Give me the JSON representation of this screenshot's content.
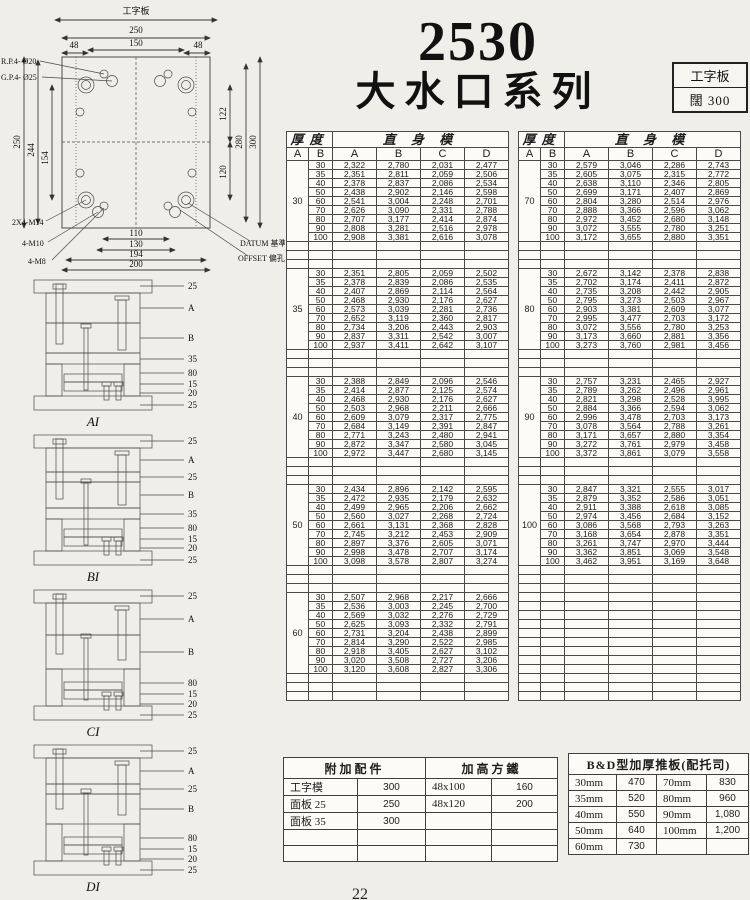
{
  "page": {
    "title_number": "2530",
    "title_series": "大水口系列",
    "page_number": "22"
  },
  "spec_box": {
    "line1": "工字板",
    "line2": "闊 300"
  },
  "drawing": {
    "title": "工字板",
    "dim_250_h": "250",
    "dim_150": "150",
    "dim_48_l": "48",
    "dim_48_r": "48",
    "dim_250_v": "250",
    "dim_244": "244",
    "dim_154": "154",
    "dim_122": "122",
    "dim_120": "120",
    "dim_280": "280",
    "dim_300": "300",
    "dim_110": "110",
    "dim_130": "130",
    "dim_194": "194",
    "dim_200": "200",
    "callout_rp": "R.P.4- Ø20",
    "callout_gp": "G.P.4- Ø25",
    "callout_m14": "2X4-M14",
    "callout_m10": "4-M10",
    "callout_m8": "4-M8",
    "callout_datum": "DATUM 基準",
    "callout_offset": "OFFSET 偏孔"
  },
  "diagrams": [
    {
      "label": "AI",
      "callouts": [
        "25",
        "A",
        "B",
        "35",
        "80",
        "15",
        "20",
        "25"
      ]
    },
    {
      "label": "BI",
      "callouts": [
        "25",
        "A",
        "25",
        "B",
        "35",
        "80",
        "15",
        "20",
        "25"
      ]
    },
    {
      "label": "CI",
      "callouts": [
        "25",
        "A",
        "B",
        "80",
        "15",
        "20",
        "25"
      ]
    },
    {
      "label": "DI",
      "callouts": [
        "25",
        "A",
        "25",
        "B",
        "80",
        "15",
        "20",
        "25"
      ]
    }
  ],
  "table_header": {
    "thickness": "厚度",
    "group": "直 身 模",
    "a": "A",
    "b": "B",
    "ca": "A",
    "cb": "B",
    "cc": "C",
    "cd": "D"
  },
  "left_table": {
    "blocks": [
      {
        "a": "30",
        "rows": [
          [
            "30",
            "2,322",
            "2,780",
            "2,031",
            "2,477"
          ],
          [
            "35",
            "2,351",
            "2,811",
            "2,059",
            "2,506"
          ],
          [
            "40",
            "2,378",
            "2,837",
            "2,086",
            "2,534"
          ],
          [
            "50",
            "2,438",
            "2,902",
            "2,146",
            "2,598"
          ],
          [
            "60",
            "2,541",
            "3,004",
            "2,248",
            "2,701"
          ],
          [
            "70",
            "2,626",
            "3,090",
            "2,331",
            "2,788"
          ],
          [
            "80",
            "2,707",
            "3,177",
            "2,414",
            "2,874"
          ],
          [
            "90",
            "2,808",
            "3,281",
            "2,516",
            "2,978"
          ],
          [
            "100",
            "2,908",
            "3,381",
            "2,616",
            "3,078"
          ]
        ]
      },
      {
        "a": "35",
        "rows": [
          [
            "30",
            "2,351",
            "2,805",
            "2,059",
            "2,502"
          ],
          [
            "35",
            "2,378",
            "2,839",
            "2,086",
            "2,535"
          ],
          [
            "40",
            "2,407",
            "2,869",
            "2,114",
            "2,564"
          ],
          [
            "50",
            "2,468",
            "2,930",
            "2,176",
            "2,627"
          ],
          [
            "60",
            "2,573",
            "3,039",
            "2,281",
            "2,736"
          ],
          [
            "70",
            "2,652",
            "3,119",
            "2,360",
            "2,817"
          ],
          [
            "80",
            "2,734",
            "3,206",
            "2,443",
            "2,903"
          ],
          [
            "90",
            "2,837",
            "3,311",
            "2,542",
            "3,007"
          ],
          [
            "100",
            "2,937",
            "3,411",
            "2,642",
            "3,107"
          ]
        ]
      },
      {
        "a": "40",
        "rows": [
          [
            "30",
            "2,388",
            "2,849",
            "2,096",
            "2,546"
          ],
          [
            "35",
            "2,414",
            "2,877",
            "2,125",
            "2,574"
          ],
          [
            "40",
            "2,468",
            "2,930",
            "2,176",
            "2,627"
          ],
          [
            "50",
            "2,503",
            "2,968",
            "2,211",
            "2,666"
          ],
          [
            "60",
            "2,609",
            "3,079",
            "2,317",
            "2,775"
          ],
          [
            "70",
            "2,684",
            "3,149",
            "2,391",
            "2,847"
          ],
          [
            "80",
            "2,771",
            "3,243",
            "2,480",
            "2,941"
          ],
          [
            "90",
            "2,872",
            "3,347",
            "2,580",
            "3,045"
          ],
          [
            "100",
            "2,972",
            "3,447",
            "2,680",
            "3,145"
          ]
        ]
      },
      {
        "a": "50",
        "rows": [
          [
            "30",
            "2,434",
            "2,896",
            "2,142",
            "2,595"
          ],
          [
            "35",
            "2,472",
            "2,935",
            "2,179",
            "2,632"
          ],
          [
            "40",
            "2,499",
            "2,965",
            "2,206",
            "2,662"
          ],
          [
            "50",
            "2,560",
            "3,027",
            "2,268",
            "2,724"
          ],
          [
            "60",
            "2,661",
            "3,131",
            "2,368",
            "2,828"
          ],
          [
            "70",
            "2,745",
            "3,212",
            "2,453",
            "2,909"
          ],
          [
            "80",
            "2,897",
            "3,376",
            "2,605",
            "3,071"
          ],
          [
            "90",
            "2,998",
            "3,478",
            "2,707",
            "3,174"
          ],
          [
            "100",
            "3,098",
            "3,578",
            "2,807",
            "3,274"
          ]
        ]
      },
      {
        "a": "60",
        "rows": [
          [
            "30",
            "2,507",
            "2,968",
            "2,217",
            "2,666"
          ],
          [
            "35",
            "2,536",
            "3,003",
            "2,245",
            "2,700"
          ],
          [
            "40",
            "2,569",
            "3,032",
            "2,276",
            "2,729"
          ],
          [
            "50",
            "2,625",
            "3,093",
            "2,332",
            "2,791"
          ],
          [
            "60",
            "2,731",
            "3,204",
            "2,438",
            "2,899"
          ],
          [
            "70",
            "2,814",
            "3,290",
            "2,522",
            "2,985"
          ],
          [
            "80",
            "2,918",
            "3,405",
            "2,627",
            "3,102"
          ],
          [
            "90",
            "3,020",
            "3,508",
            "2,727",
            "3,206"
          ],
          [
            "100",
            "3,120",
            "3,608",
            "2,827",
            "3,306"
          ]
        ]
      }
    ]
  },
  "right_table": {
    "blocks": [
      {
        "a": "70",
        "rows": [
          [
            "30",
            "2,579",
            "3,046",
            "2,286",
            "2,743"
          ],
          [
            "35",
            "2,605",
            "3,075",
            "2,315",
            "2,772"
          ],
          [
            "40",
            "2,638",
            "3,110",
            "2,346",
            "2,805"
          ],
          [
            "50",
            "2,699",
            "3,171",
            "2,407",
            "2,869"
          ],
          [
            "60",
            "2,804",
            "3,280",
            "2,514",
            "2,976"
          ],
          [
            "70",
            "2,888",
            "3,366",
            "2,596",
            "3,062"
          ],
          [
            "80",
            "2,972",
            "3,452",
            "2,680",
            "3,148"
          ],
          [
            "90",
            "3,072",
            "3,555",
            "2,780",
            "3,251"
          ],
          [
            "100",
            "3,172",
            "3,655",
            "2,880",
            "3,351"
          ]
        ]
      },
      {
        "a": "80",
        "rows": [
          [
            "30",
            "2,672",
            "3,142",
            "2,378",
            "2,838"
          ],
          [
            "35",
            "2,702",
            "3,174",
            "2,411",
            "2,872"
          ],
          [
            "40",
            "2,735",
            "3,208",
            "2,442",
            "2,905"
          ],
          [
            "50",
            "2,795",
            "3,273",
            "2,503",
            "2,967"
          ],
          [
            "60",
            "2,903",
            "3,381",
            "2,609",
            "3,077"
          ],
          [
            "70",
            "2,995",
            "3,477",
            "2,703",
            "3,172"
          ],
          [
            "80",
            "3,072",
            "3,556",
            "2,780",
            "3,253"
          ],
          [
            "90",
            "3,173",
            "3,660",
            "2,881",
            "3,356"
          ],
          [
            "100",
            "3,273",
            "3,760",
            "2,981",
            "3,456"
          ]
        ]
      },
      {
        "a": "90",
        "rows": [
          [
            "30",
            "2,757",
            "3,231",
            "2,465",
            "2,927"
          ],
          [
            "35",
            "2,789",
            "3,262",
            "2,496",
            "2,961"
          ],
          [
            "40",
            "2,821",
            "3,298",
            "2,528",
            "3,995"
          ],
          [
            "50",
            "2,884",
            "3,366",
            "2,594",
            "3,062"
          ],
          [
            "60",
            "2,996",
            "3,478",
            "2,703",
            "3,173"
          ],
          [
            "70",
            "3,078",
            "3,564",
            "2,788",
            "3,261"
          ],
          [
            "80",
            "3,171",
            "3,657",
            "2,880",
            "3,354"
          ],
          [
            "90",
            "3,272",
            "3,761",
            "2,979",
            "3,458"
          ],
          [
            "100",
            "3,372",
            "3,861",
            "3,079",
            "3,558"
          ]
        ]
      },
      {
        "a": "100",
        "rows": [
          [
            "30",
            "2,847",
            "3,321",
            "2,555",
            "3,017"
          ],
          [
            "35",
            "2,879",
            "3,352",
            "2,586",
            "3,051"
          ],
          [
            "40",
            "2,911",
            "3,388",
            "2,618",
            "3,085"
          ],
          [
            "50",
            "2,974",
            "3,456",
            "2,684",
            "3,152"
          ],
          [
            "60",
            "3,086",
            "3,568",
            "2,793",
            "3,263"
          ],
          [
            "70",
            "3,168",
            "3,654",
            "2,878",
            "3,351"
          ],
          [
            "80",
            "3,261",
            "3,747",
            "2,970",
            "3,444"
          ],
          [
            "90",
            "3,362",
            "3,851",
            "3,069",
            "3,548"
          ],
          [
            "100",
            "3,462",
            "3,951",
            "3,169",
            "3,648"
          ]
        ]
      }
    ]
  },
  "accessories_table": {
    "header_left": "附加配件",
    "header_right": "加高方鐵",
    "rows": [
      [
        "工字模",
        "300",
        "48x100",
        "160"
      ],
      [
        "面板 25",
        "250",
        "48x120",
        "200"
      ],
      [
        "面板 35",
        "300",
        "",
        ""
      ],
      [
        "",
        "",
        "",
        ""
      ],
      [
        "",
        "",
        "",
        ""
      ]
    ]
  },
  "bd_table": {
    "header": "B&D型加厚推板(配托司)",
    "rows": [
      [
        "30mm",
        "470",
        "70mm",
        "830"
      ],
      [
        "35mm",
        "520",
        "80mm",
        "960"
      ],
      [
        "40mm",
        "550",
        "90mm",
        "1,080"
      ],
      [
        "50mm",
        "640",
        "100mm",
        "1,200"
      ],
      [
        "60mm",
        "730",
        "",
        ""
      ]
    ]
  }
}
